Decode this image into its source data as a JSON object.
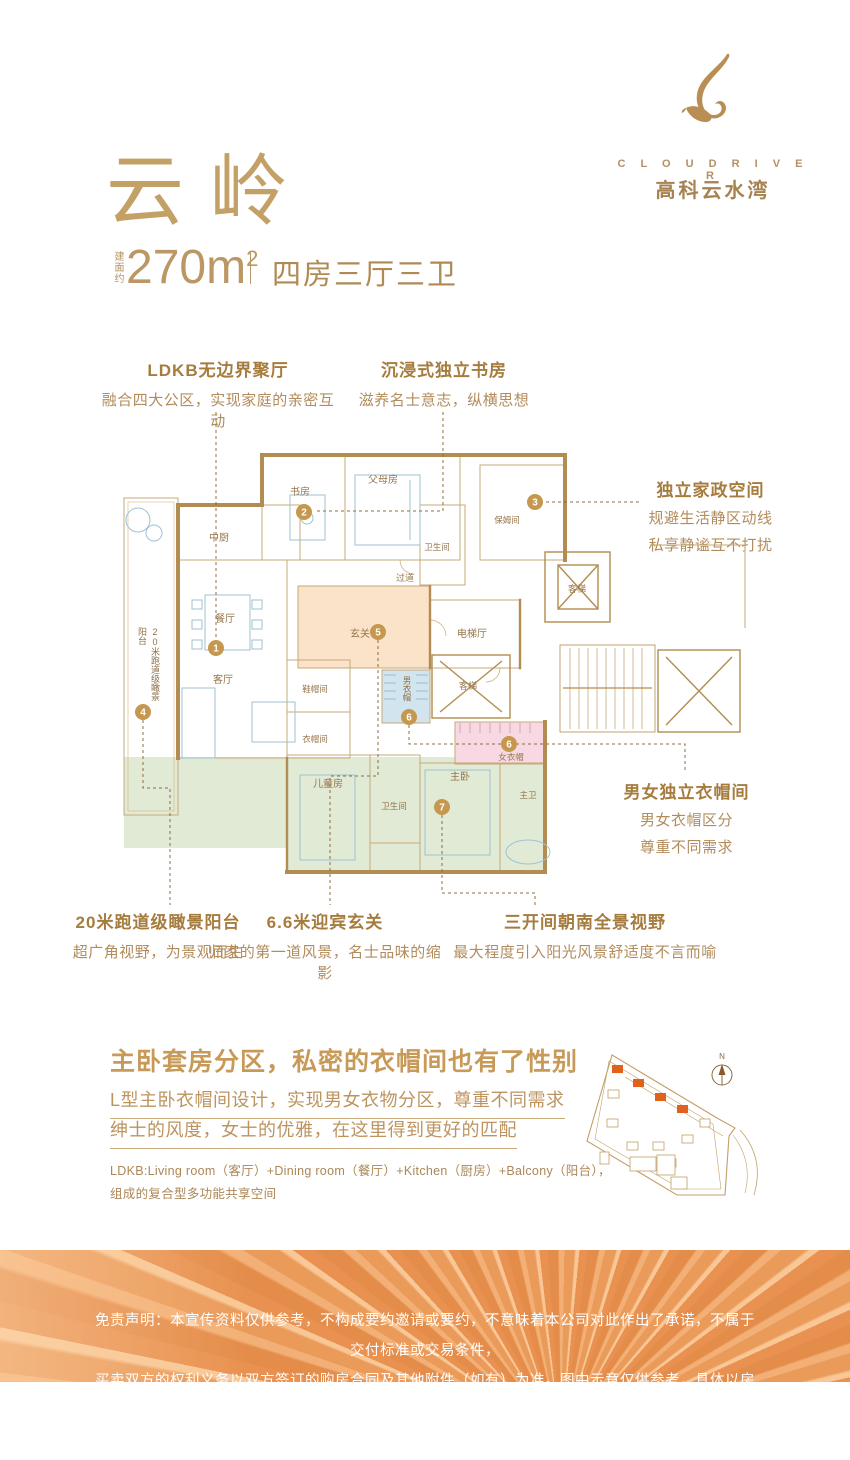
{
  "brand": {
    "logo_en": "C L O U D   R I V E R",
    "logo_cn": "高科云水湾"
  },
  "header": {
    "title": "云 岭",
    "area_prefix": "建面约",
    "area_value": "270m",
    "area_sup": "2",
    "divider": "|",
    "layout": "四房三厅三卫"
  },
  "callouts": {
    "ldkb": {
      "title": "LDKB无边界聚厅",
      "desc": "融合四大公区，实现家庭的亲密互动"
    },
    "study": {
      "title": "沉浸式独立书房",
      "desc": "滋养名士意志，纵横思想"
    },
    "housework": {
      "title": "独立家政空间",
      "line1": "规避生活静区动线",
      "line2": "私享静谧互不打扰"
    },
    "cloakroom": {
      "title": "男女独立衣帽间",
      "line1": "男女衣帽区分",
      "line2": "尊重不同需求"
    },
    "balcony": {
      "title": "20米跑道级瞰景阳台",
      "desc": "超广角视野，为景观而生"
    },
    "foyer": {
      "title": "6.6米迎宾玄关",
      "desc": "归家的第一道风景，名士品味的缩影"
    },
    "south": {
      "title": "三开间朝南全景视野",
      "desc": "最大程度引入阳光风景舒适度不言而喻"
    }
  },
  "plan": {
    "rooms": {
      "kitchen": "中厨",
      "study": "书房",
      "parents": "父母房",
      "bath_up": "卫生间",
      "nanny": "保姆间",
      "corridor": "过道",
      "dining": "餐厅",
      "foyer": "玄关",
      "living": "客厅",
      "shoe": "鞋帽间",
      "cloak": "衣帽间",
      "men_cloak": "男衣帽",
      "kids": "儿童房",
      "bath_down": "卫生间",
      "master": "主卧",
      "master_bath": "主卫",
      "women_cloak": "女衣帽",
      "elevator_hall": "电梯厅",
      "elevator1": "客梯",
      "elevator2": "客梯",
      "balcony_v": "20米跑道级瞰景阳台"
    },
    "markers": {
      "m1": "1",
      "m2": "2",
      "m3": "3",
      "m4": "4",
      "m5": "5",
      "m6a": "6",
      "m6b": "6",
      "m7": "7"
    }
  },
  "section": {
    "heading": "主卧套房分区，私密的衣帽间也有了性别",
    "line1": "L型主卧衣帽间设计，实现男女衣物分区，尊重不同需求",
    "line2": "绅士的风度，女士的优雅，在这里得到更好的匹配",
    "note1": "LDKB:Living room（客厅）+Dining room（餐厅）+Kitchen（厨房）+Balcony（阳台），",
    "note2": "组成的复合型多功能共享空间"
  },
  "siteplan": {
    "compass_n": "N"
  },
  "disclaimer": {
    "line1": "免责声明：本宣传资料仅供参考，不构成要约邀请或要约，不意味着本公司对此作出了承诺，不属于交付标准或交易条件，",
    "line2": "买卖双方的权利义务以双方签订的购房合同及其他附件（如有）为准。图中示意仅供参考，具体以房屋交付时为准。"
  },
  "colors": {
    "gold_title": "#c3a065",
    "callout_title": "#a67c3e",
    "callout_body": "#b28c5c",
    "wall": "#b28c50",
    "marker": "#c6974e",
    "zone_peach": "#fae3c9",
    "zone_green": "#dde8d0",
    "zone_pink": "#f8d9e3",
    "zone_blue": "#d2e5ee",
    "band_orange": "#e8944f",
    "site_orange": "#e0601c",
    "heading_gold": "#c89a58"
  }
}
